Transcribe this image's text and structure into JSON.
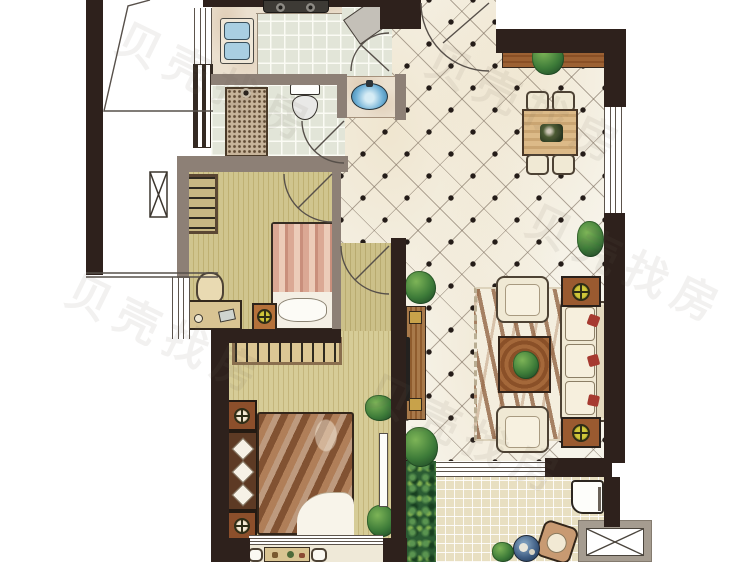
{
  "meta": {
    "canvas_width": 750,
    "canvas_height": 562,
    "type": "apartment-floor-plan",
    "text_labels_visible": false
  },
  "watermark": {
    "text": "贝壳找房",
    "style": "faint diagonal repeated"
  },
  "palette": {
    "wall_dark": "#2e211c",
    "wall_gray": "#8d8076",
    "tile_light": "#e2e5d8",
    "diamond_floor": "#f6f3e9",
    "diamond_dot": "#241c18",
    "bedroom_floor": "#d0c58e",
    "master_floor": "#d6cc97",
    "terrace_tile": "#e8dfc1",
    "wood_brown": "#9c6133",
    "seat_cream": "#f0e9d4",
    "pillow_red": "#a63a30",
    "sink_blue": "#a9cfe2",
    "basin_blue": "#6fb0d6",
    "lamp_yellow": "#cfc63a",
    "plant_green": "#3c7a38",
    "bush_green": "#2b5c33",
    "marble": "#ebe0cf"
  },
  "plan": {
    "rooms": [
      {
        "id": "kitchen",
        "furniture": [
          "l-counter",
          "double-sink",
          "two-burner-stove",
          "refrigerator"
        ],
        "floor": "square-tile",
        "door": "swing"
      },
      {
        "id": "bathroom",
        "furniture": [
          "shower-area",
          "toilet",
          "wash-basin-vanity"
        ],
        "floor": "square-tile",
        "door": "swing"
      },
      {
        "id": "dining-area",
        "furniture": [
          "sideboard",
          "plant",
          "dining-table",
          "four-chairs"
        ],
        "floor": "diamond-tile"
      },
      {
        "id": "living-room",
        "furniture": [
          "three-seat-sofa",
          "two-armchairs",
          "coffee-table",
          "zebra-rug",
          "tv-cabinet",
          "two-side-tables-with-lamps",
          "plants"
        ],
        "floor": "diamond-tile"
      },
      {
        "id": "second-bedroom",
        "furniture": [
          "single-bed",
          "wardrobe",
          "desk",
          "chair",
          "nightstand"
        ],
        "floor": "wood-strip",
        "door": "swing"
      },
      {
        "id": "master-bedroom",
        "furniture": [
          "double-bed",
          "wardrobe-rail",
          "two-nightstands",
          "headboard-pillows",
          "mirror",
          "plants"
        ],
        "floor": "wood-strip",
        "door": "swing"
      },
      {
        "id": "rear-balcony",
        "furniture": [
          "bistro-table",
          "two-chairs"
        ],
        "floor": "stone"
      },
      {
        "id": "terrace",
        "furniture": [
          "washing-machine",
          "lounge-chair",
          "round-table",
          "plants",
          "hedge"
        ],
        "floor": "small-tile"
      }
    ],
    "exterior": [
      "void-with-diagonal-outline",
      "structural-column",
      "ac-outdoor-unit"
    ],
    "windows": 6,
    "entry_door": "top-right swing"
  }
}
